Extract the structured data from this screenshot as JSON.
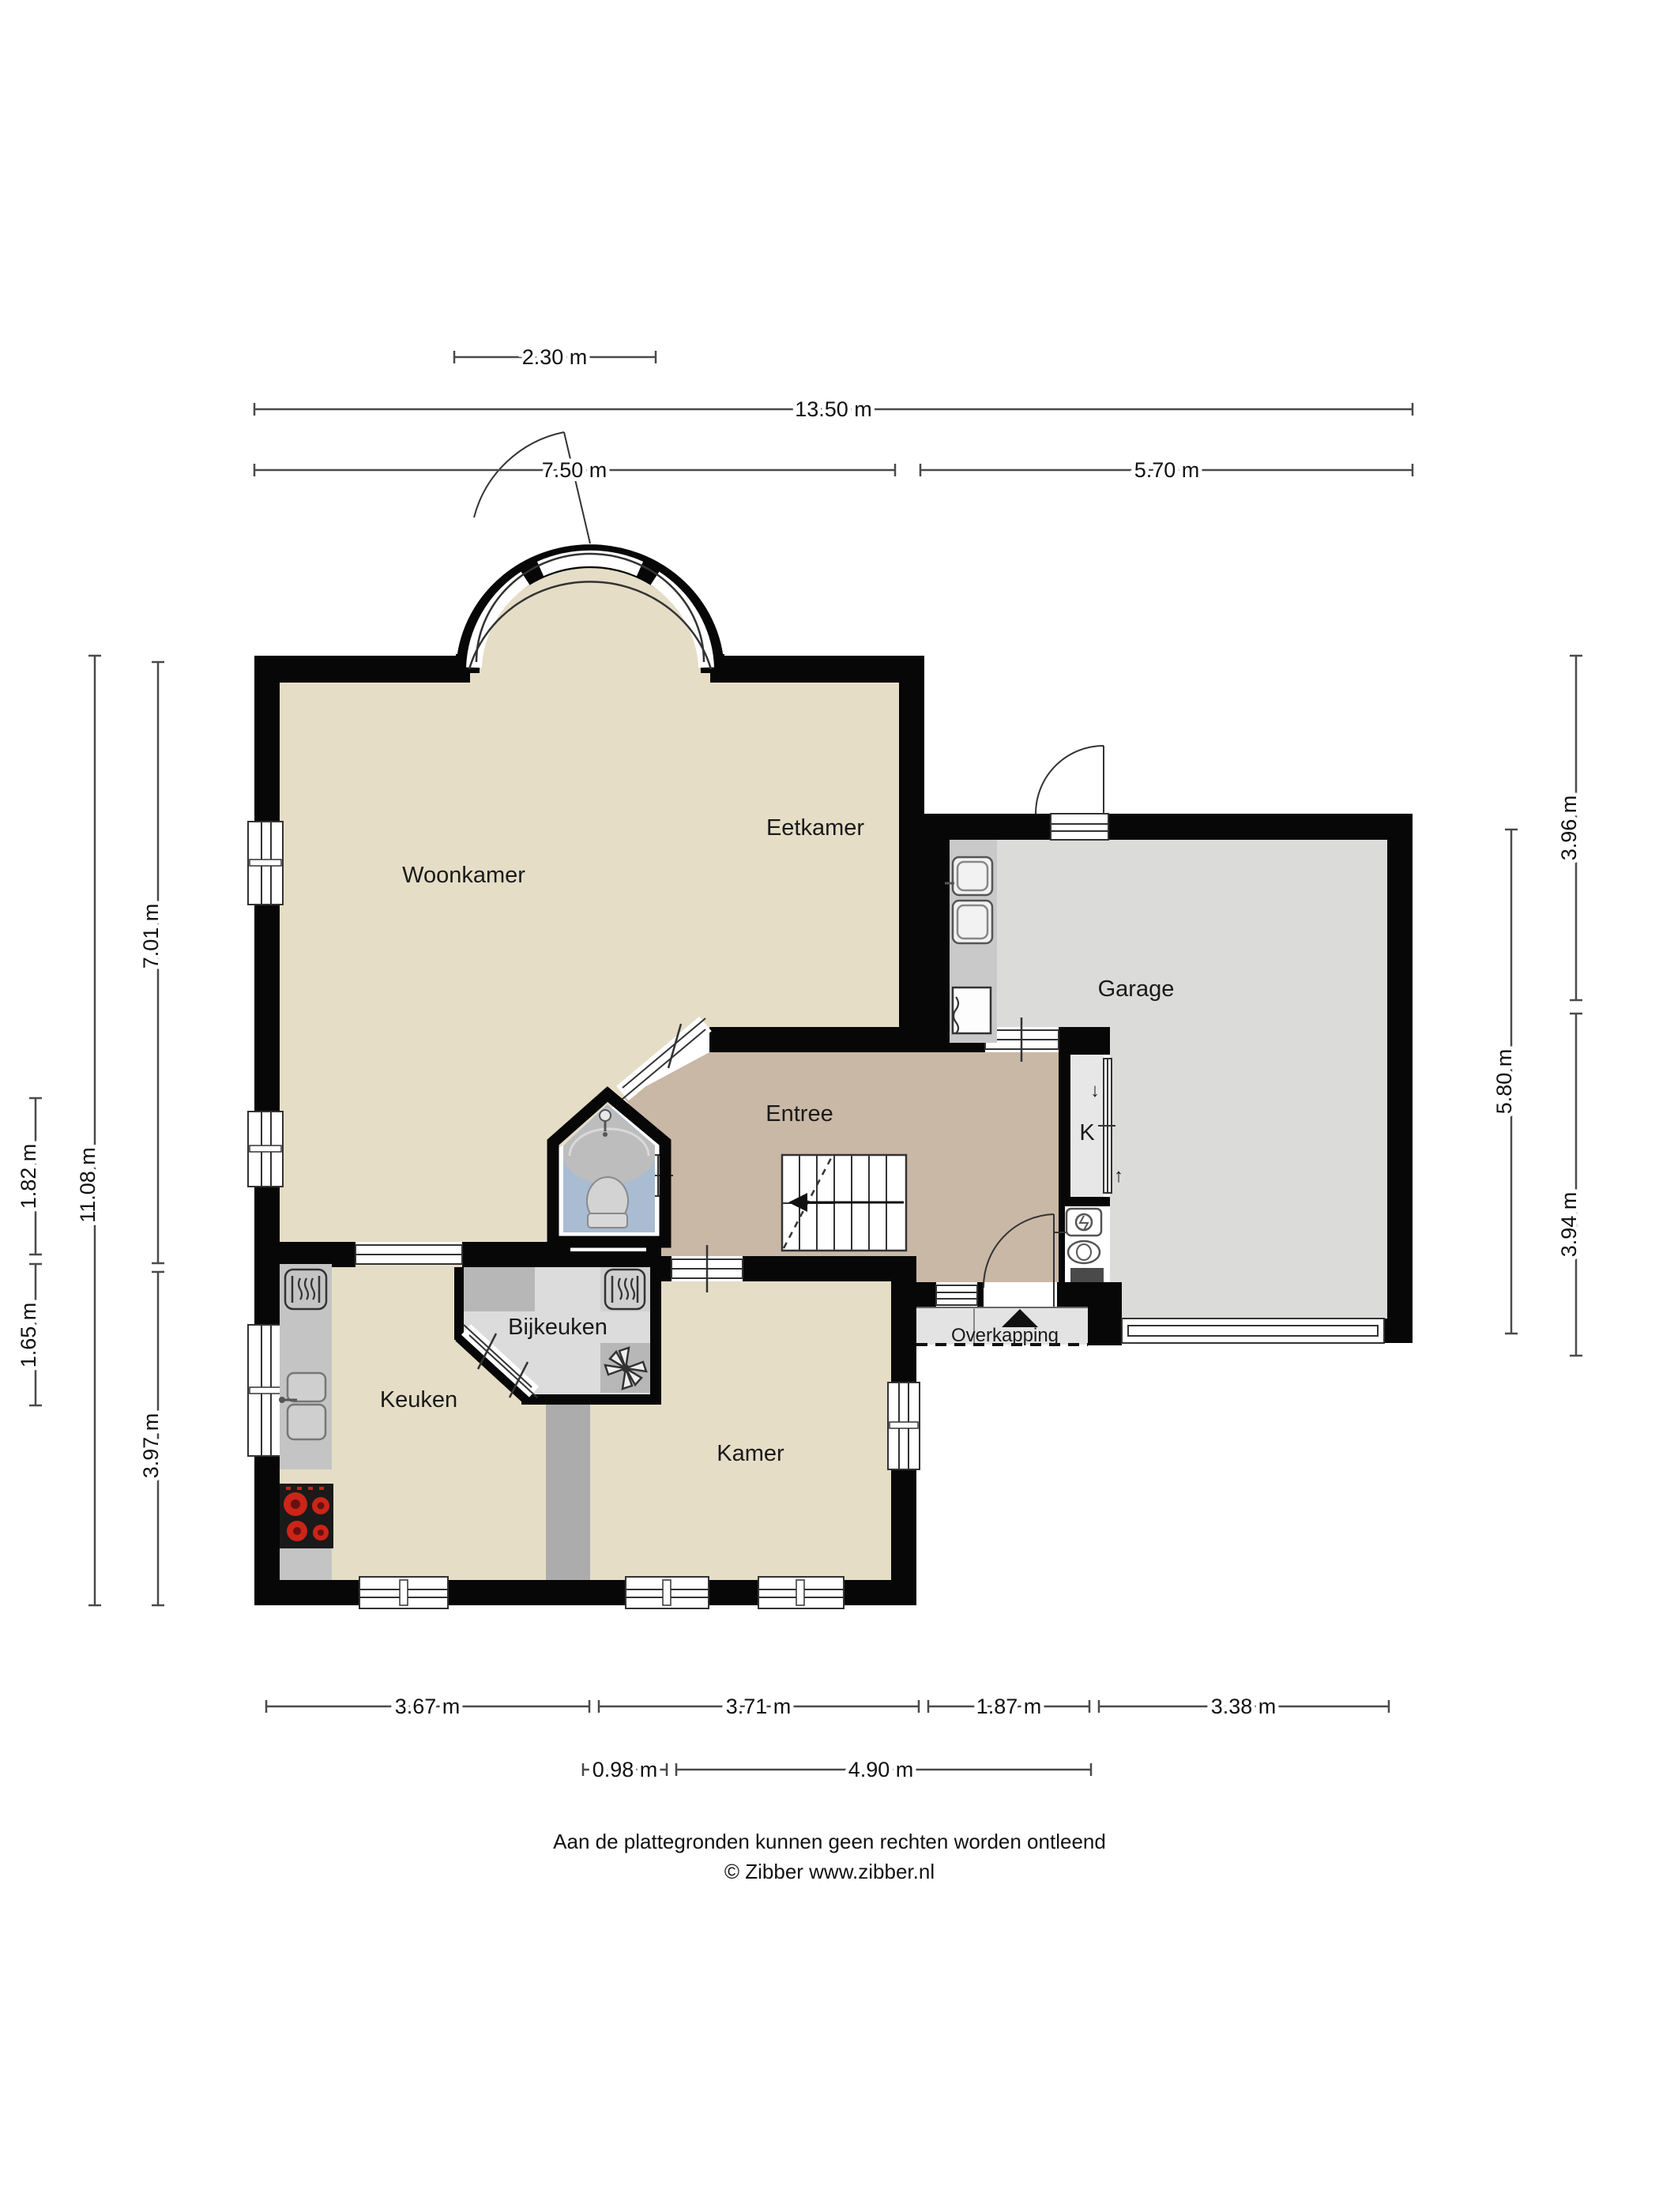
{
  "document": {
    "type": "floorplan",
    "footer": {
      "line1": "Aan de plattegronden kunnen geen rechten worden ontleend",
      "line2": "© Zibber www.zibber.nl"
    }
  },
  "rooms": {
    "woonkamer": "Woonkamer",
    "eetkamer": "Eetkamer",
    "entree": "Entree",
    "garage": "Garage",
    "keuken": "Keuken",
    "bijkeuken": "Bijkeuken",
    "kamer": "Kamer",
    "overkapping": "Overkapping",
    "kast": "K"
  },
  "k_closet": {
    "arrow_down": "↓",
    "arrow_up": "↑"
  },
  "dimensions": {
    "top": [
      {
        "label": "2.30 m",
        "meters": 2.3
      },
      {
        "label": "13.50 m",
        "meters": 13.5
      },
      {
        "label": "7.50 m",
        "meters": 7.5
      },
      {
        "label": "5.70 m",
        "meters": 5.7
      }
    ],
    "left": [
      {
        "label": "1.82 m",
        "meters": 1.82
      },
      {
        "label": "1.65 m",
        "meters": 1.65
      },
      {
        "label": "11.08 m",
        "meters": 11.08
      },
      {
        "label": "7.01 m",
        "meters": 7.01
      },
      {
        "label": "3.97 m",
        "meters": 3.97
      }
    ],
    "right": [
      {
        "label": "3.96 m",
        "meters": 3.96
      },
      {
        "label": "5.80 m",
        "meters": 5.8
      },
      {
        "label": "3.94 m",
        "meters": 3.94
      }
    ],
    "bottom_row1": [
      {
        "label": "3.67 m",
        "meters": 3.67
      },
      {
        "label": "3.71 m",
        "meters": 3.71
      },
      {
        "label": "1.87 m",
        "meters": 1.87
      },
      {
        "label": "3.38 m",
        "meters": 3.38
      }
    ],
    "bottom_row2": [
      {
        "label": "0.98 m",
        "meters": 0.98
      },
      {
        "label": "4.90 m",
        "meters": 4.9
      }
    ]
  },
  "colors": {
    "wall": "#070707",
    "interior_wall": "#acacac",
    "floor_living": "#e5ddc6",
    "floor_entree": "#c9b8a6",
    "floor_garage": "#dbdbda",
    "floor_utility": "#dcdcdc",
    "floor_toilet": "#a9bcd2",
    "floor_overkapping": "#e3e3e3",
    "counter": "#c4c4c4",
    "counter_dark": "#b7b7b7",
    "stove": "#1a1a1a",
    "burner_red": "#cc2418",
    "dim_line": "#4a4a4a"
  },
  "icons": {
    "shower": "shower-icon",
    "toilet": "toilet-icon",
    "stove": "stove-icon",
    "sink": "sink-icon",
    "oven": "oven-icon",
    "boiler": "boiler-icon",
    "fan": "ventilation-fan-icon",
    "washer": "washing-machine-icon",
    "basket": "laundry-basket-icon",
    "entrance": "entrance-arrow-icon"
  }
}
